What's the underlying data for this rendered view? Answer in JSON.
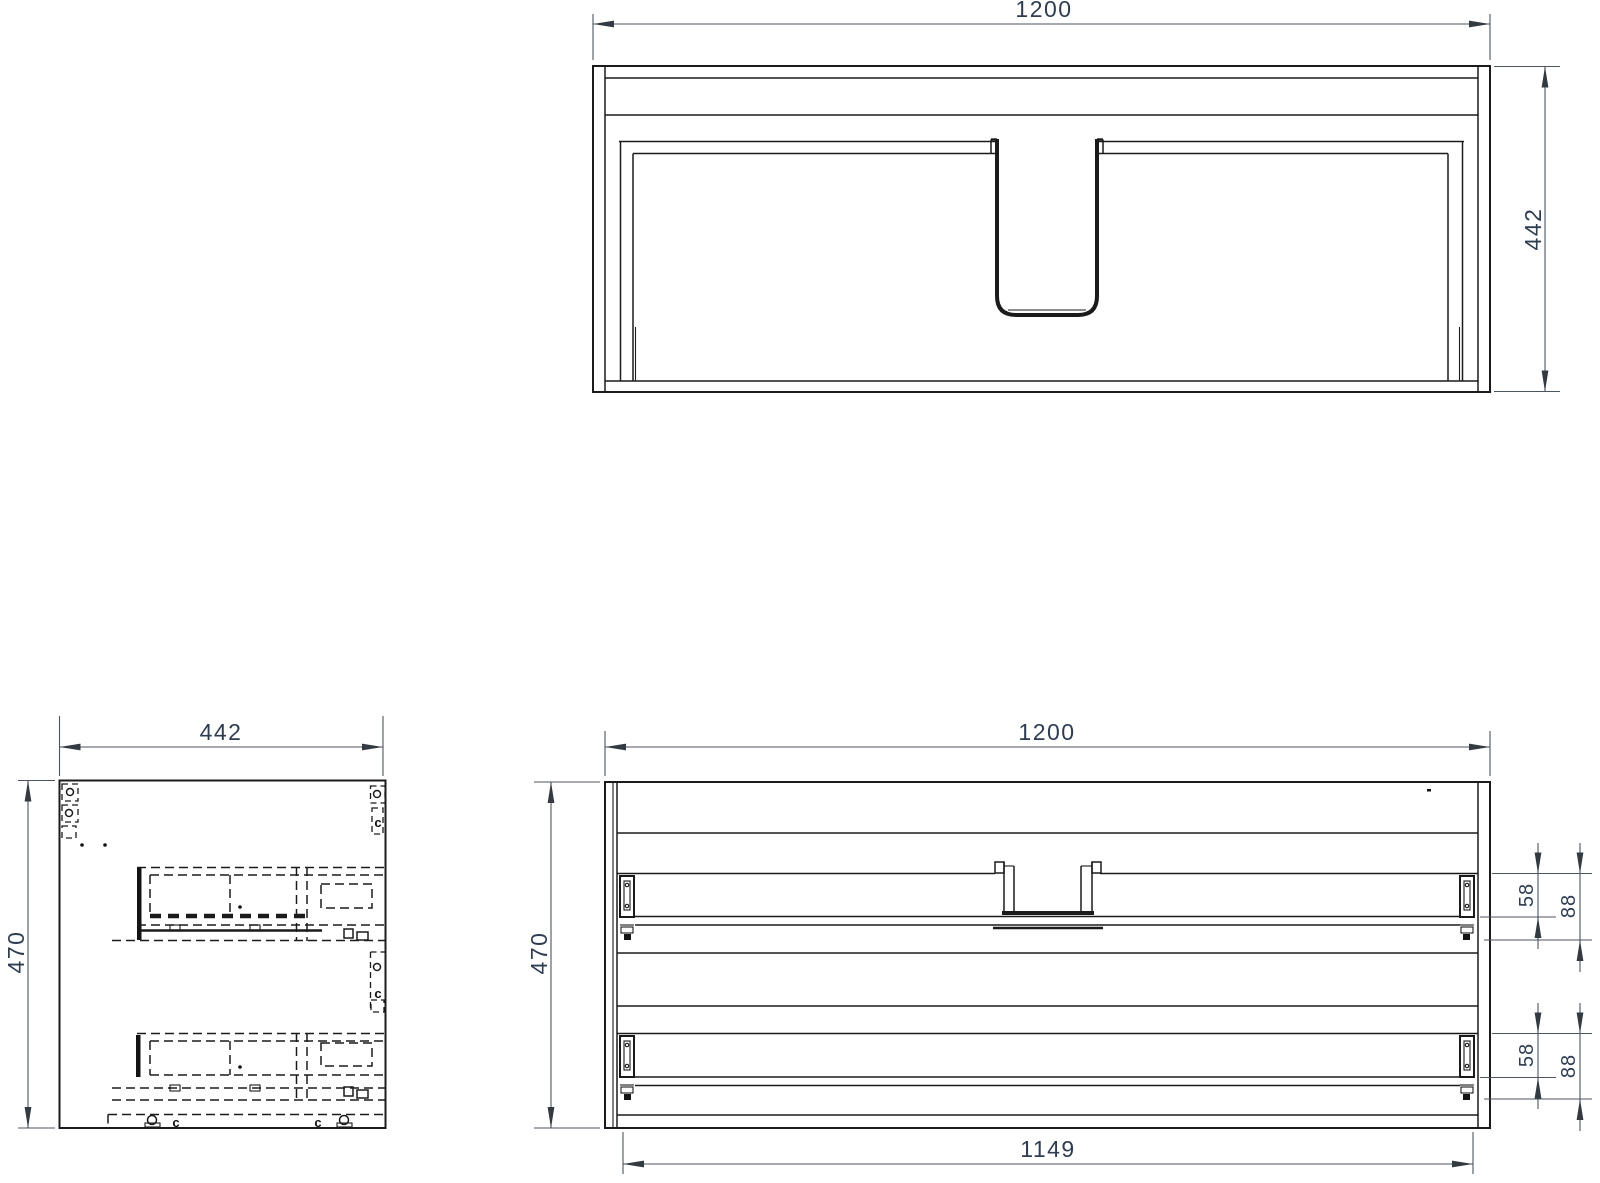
{
  "colors": {
    "line": "#1b1b1b",
    "dim_line": "#4d5560",
    "dim_text": "#2e3d52",
    "background": "#ffffff"
  },
  "top_view": {
    "dim_width": "1200",
    "dim_depth": "442"
  },
  "side_view": {
    "dim_depth": "442",
    "dim_height": "470",
    "letters": {
      "top_right": "c",
      "mid_right": "c",
      "bottom_left": "c",
      "bottom_right": "c"
    }
  },
  "front_view": {
    "dim_width": "1200",
    "dim_height": "470",
    "dim_rail_width": "1149",
    "top_drawer": {
      "dim_slide_height": "58",
      "dim_drawer_height": "88"
    },
    "bottom_drawer": {
      "dim_slide_height": "58",
      "dim_drawer_height": "88"
    }
  }
}
